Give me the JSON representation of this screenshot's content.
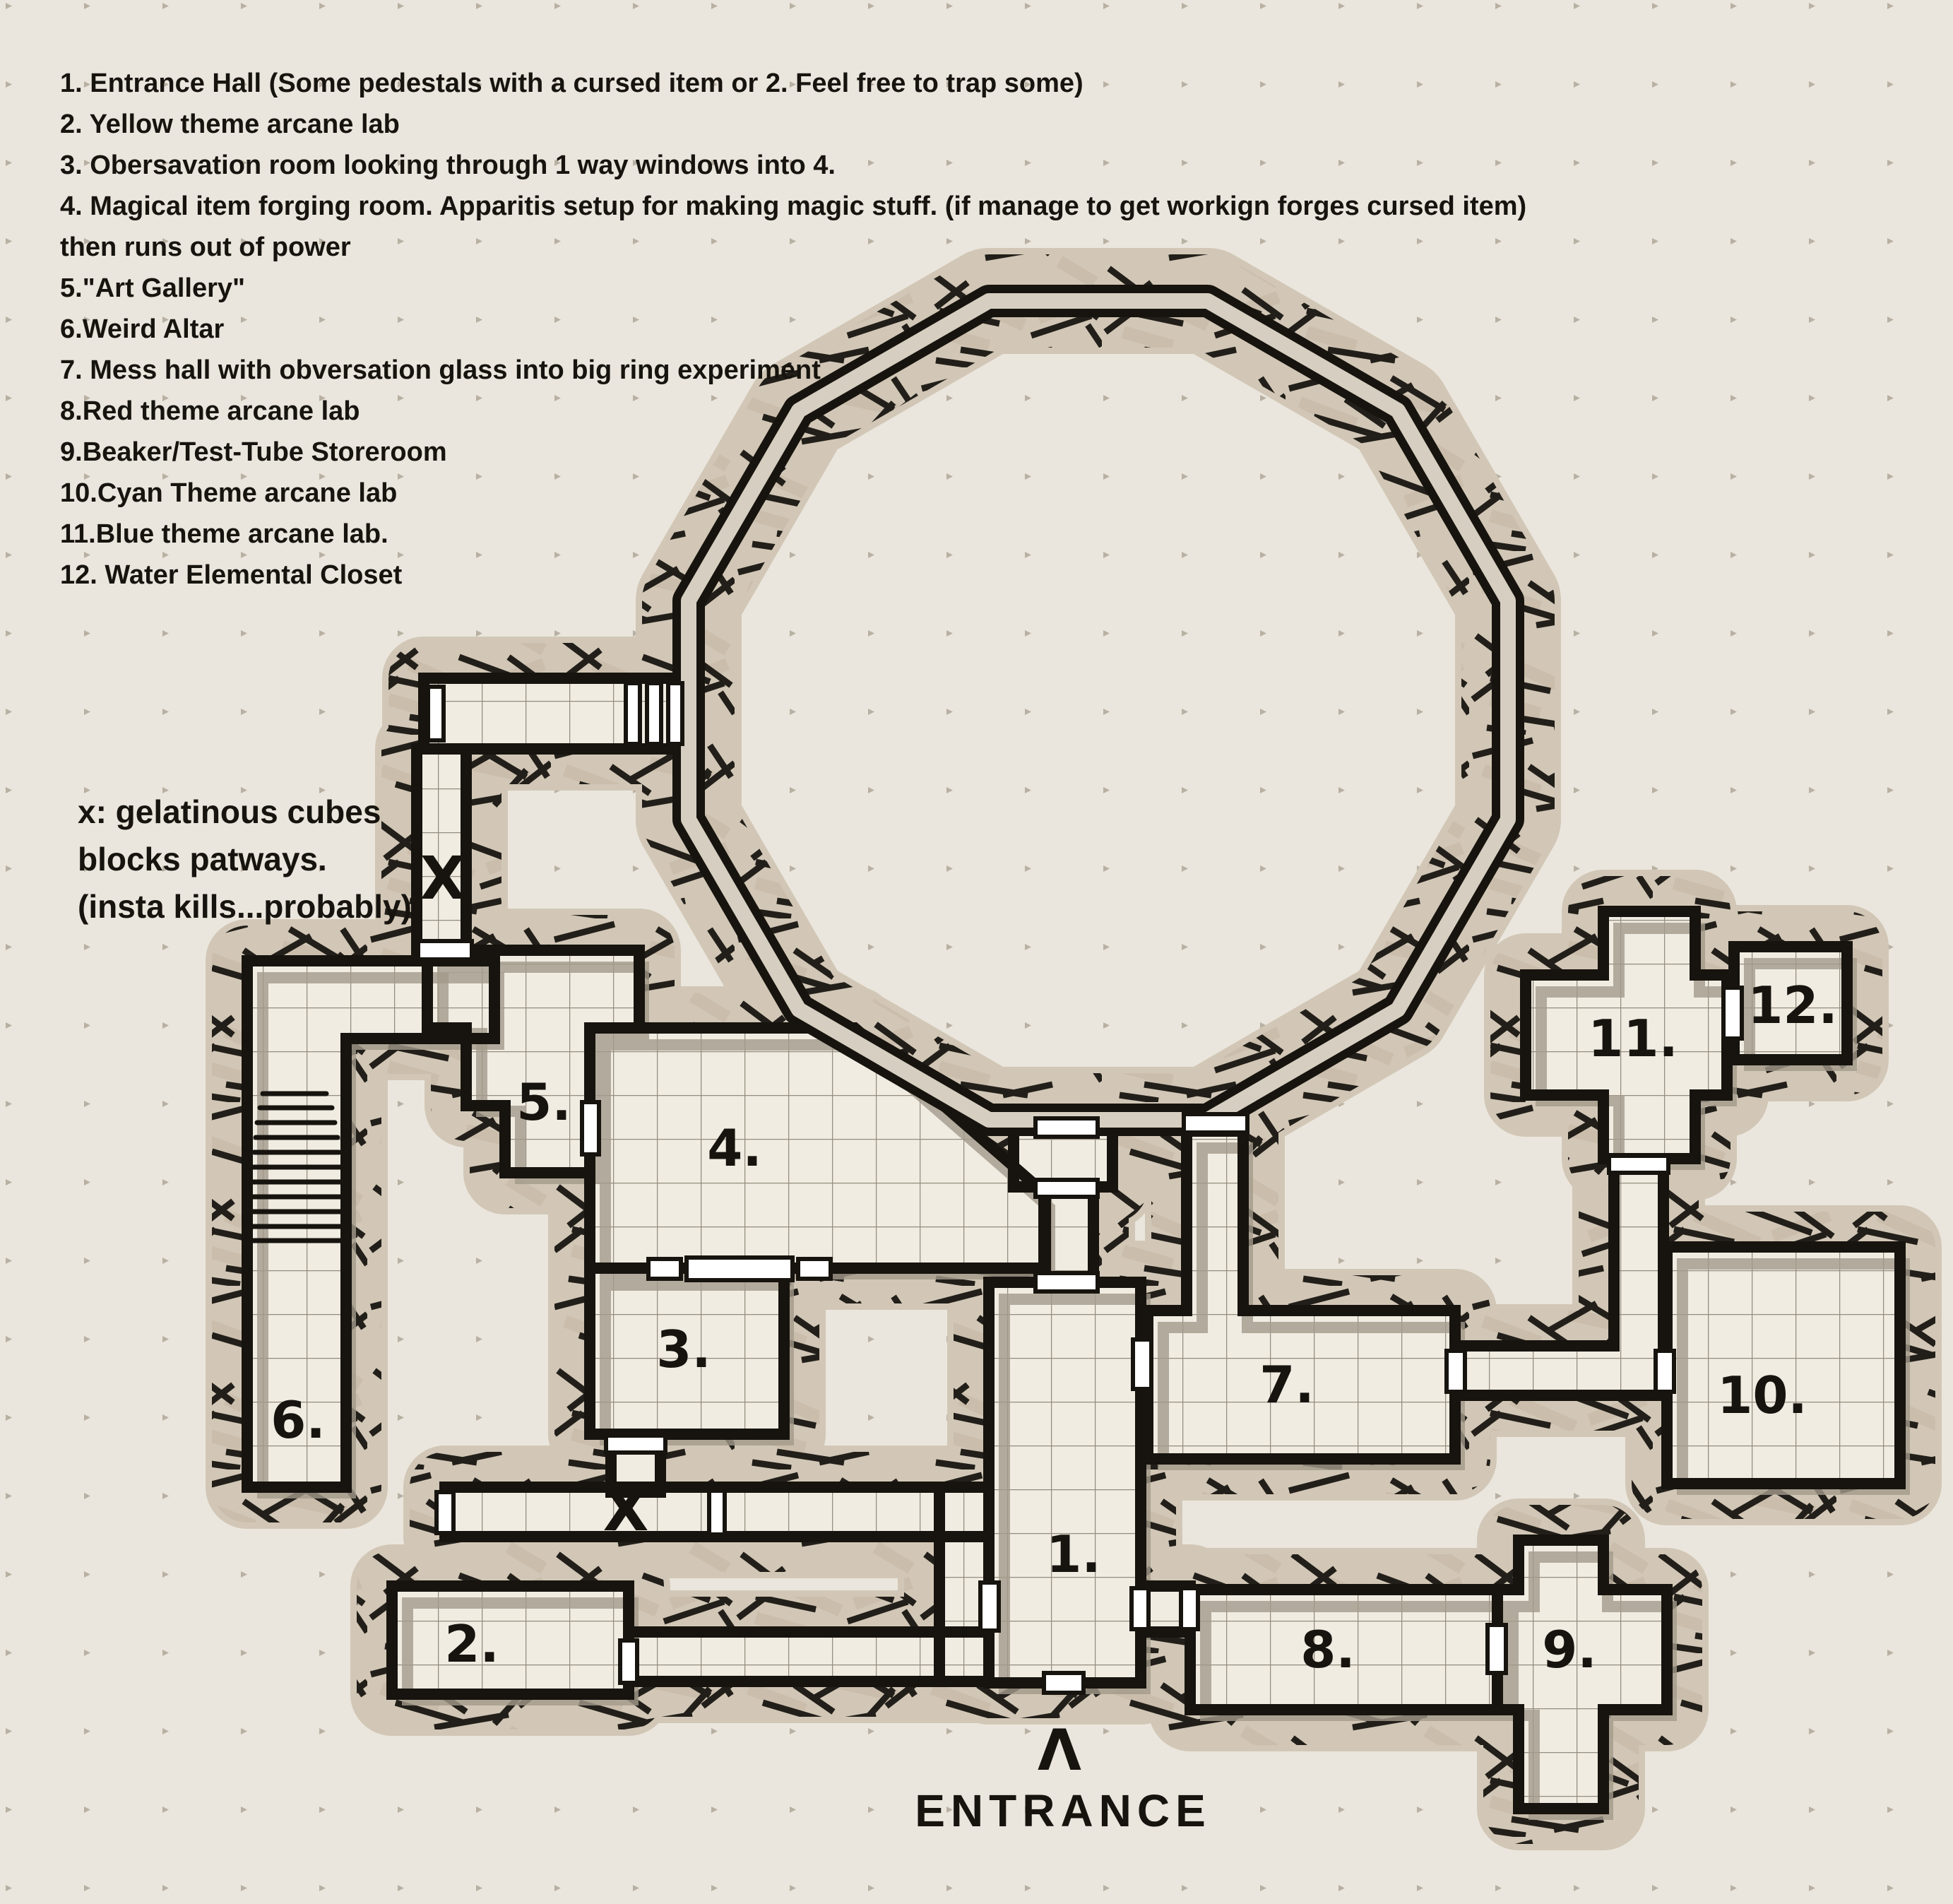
{
  "legend": {
    "lines": [
      "1. Entrance Hall (Some pedestals with a cursed item or 2. Feel free to trap some)",
      "2. Yellow theme arcane lab",
      "3. Obersavation room looking through 1 way windows into 4.",
      "4. Magical item forging room. Apparitis setup for making magic stuff. (if manage to get workign forges cursed item)",
      "then runs out of power",
      "5.\"Art Gallery\"",
      "6.Weird Altar",
      "7. Mess hall with obversation glass into big ring experiment",
      "8.Red theme arcane lab",
      "9.Beaker/Test-Tube Storeroom",
      "10.Cyan Theme arcane lab",
      "11.Blue theme arcane lab.",
      "12. Water Elemental Closet"
    ]
  },
  "note": {
    "lines": [
      "x: gelatinous cubes",
      "blocks patways.",
      "(insta kills...probably)"
    ]
  },
  "entrance": {
    "arrow": "Λ",
    "label": "ENTRANCE"
  },
  "marks": {
    "x_label": "X"
  },
  "rooms": [
    {
      "label": "1.",
      "name": "Entrance Hall"
    },
    {
      "label": "2.",
      "name": "Yellow theme arcane lab"
    },
    {
      "label": "3.",
      "name": "Obersavation room"
    },
    {
      "label": "4.",
      "name": "Magical item forging room"
    },
    {
      "label": "5.",
      "name": "Art Gallery"
    },
    {
      "label": "6.",
      "name": "Weird Altar"
    },
    {
      "label": "7.",
      "name": "Mess hall"
    },
    {
      "label": "8.",
      "name": "Red theme arcane lab"
    },
    {
      "label": "9.",
      "name": "Beaker/Test-Tube Storeroom"
    },
    {
      "label": "10.",
      "name": "Cyan Theme arcane lab"
    },
    {
      "label": "11.",
      "name": "Blue theme arcane lab"
    },
    {
      "label": "12.",
      "name": "Water Elemental Closet"
    }
  ],
  "colors": {
    "background": "#eae6dd",
    "floor": "#f0ece2",
    "wall": "#17140f",
    "grid_line": "#948c7e",
    "shadow": "#a39a8b",
    "hatch_dark": "#221f1a",
    "hatch_tan": "#cabdab",
    "door": "#ffffff"
  }
}
